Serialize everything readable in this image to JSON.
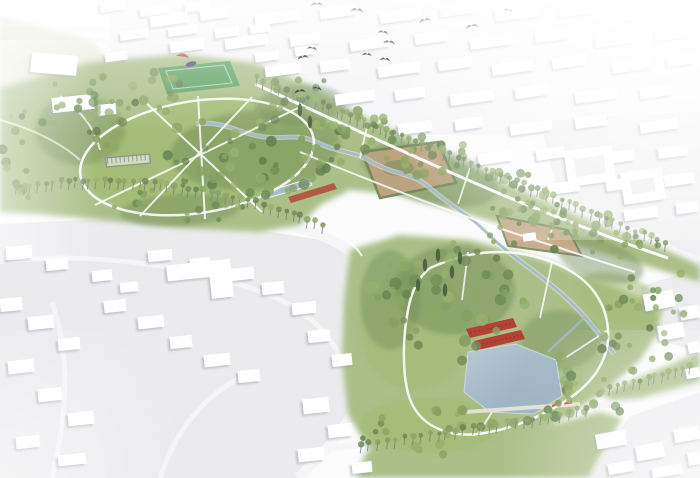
{
  "meta": {
    "title": "Aerial bird's-eye rendering of a linear park masterplan with pond, gardens and meandering stream, surrounded by white massing-model city blocks and flying birds",
    "type": "architectural-visualization",
    "view": "aerial-perspective"
  },
  "palette": {
    "bg": "#fbfbfc",
    "city_ground": "#ebebee",
    "city_ground2": "#ededf0",
    "city_ground3": "#f2f2f4",
    "building_fill": "#ffffff",
    "road": "#f6f6f8",
    "park_base": "#a9bd85",
    "lawn_light": "#a0b971",
    "wood_dark": "#6d8a52",
    "field_pale": "#e6ead8",
    "pitch_green": "#5da061",
    "water": "#a4bac9",
    "water_deep": "#8fa9bb",
    "stream": "#9fb6c6",
    "flower_red": "#b03a2c",
    "flower_dark": "#7e2a20",
    "garden_tan": "#b99e79",
    "garden_tan2": "#c2a684",
    "hedge_green": "#6a8150",
    "pergola_gray": "#8a8e93",
    "bird_black": "#1d1d1d",
    "path_white": "#fdfdfd",
    "pavilion_red": "#bb4540",
    "pavilion_purple": "#5a4070",
    "boardwalk": "#e7e2d6",
    "bench_orange": "#c0512f",
    "tree_trunk": "#777d72",
    "conifer": "#3f5a35"
  },
  "scene": {
    "birds": {
      "count": 13,
      "positions": [
        [
          317,
          5,
          1
        ],
        [
          357,
          11,
          1.1
        ],
        [
          383,
          33,
          0.9
        ],
        [
          389,
          43,
          1
        ],
        [
          425,
          21,
          1
        ],
        [
          472,
          27,
          1.1
        ],
        [
          508,
          11,
          0.85
        ],
        [
          312,
          49,
          0.85
        ],
        [
          303,
          58,
          0.95
        ],
        [
          367,
          55,
          0.8
        ],
        [
          385,
          60,
          0.9
        ],
        [
          300,
          92,
          0.95
        ],
        [
          317,
          89,
          0.8
        ]
      ]
    },
    "tree_colors": [
      "#6d8a52",
      "#7f9c5c",
      "#93ad68",
      "#5f7d4a",
      "#88a35f"
    ],
    "park_features": [
      "central-lawn-with-loop-path",
      "sports-pitch",
      "canopy-pavilion",
      "pergola",
      "linear-reflecting-pool",
      "linear-flower-strip",
      "community-garden-plot-upper",
      "community-garden-plot-lower",
      "meandering-stream",
      "main-pond",
      "boardwalk-with-benches",
      "red-flower-beds",
      "tree-allees",
      "conifer-grove"
    ],
    "city_districts": [
      "north-city-blocks",
      "northwest-housing-rows",
      "southwest-housing-estate",
      "east-perimeter-blocks",
      "southeast-blocks",
      "pale-field-northwest"
    ],
    "water_bodies": [
      "main-pond",
      "linear-reflecting-pool",
      "stream"
    ]
  }
}
